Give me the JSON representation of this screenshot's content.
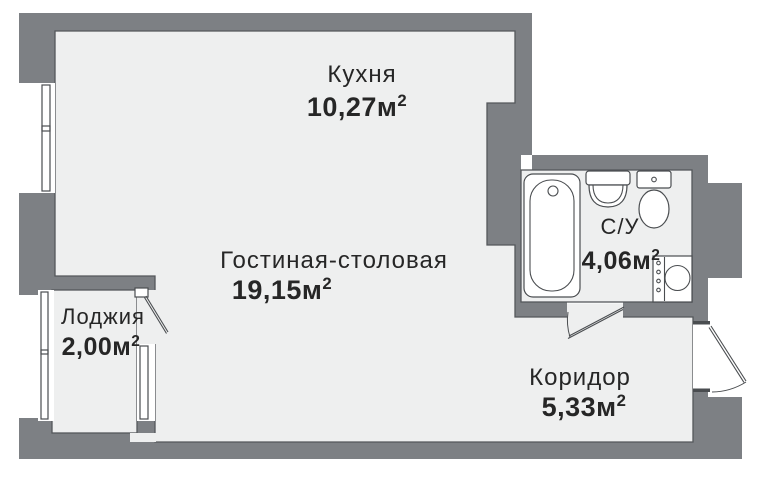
{
  "plan": {
    "title": "Studio apartment floor plan",
    "rooms": [
      {
        "id": "kitchen",
        "name": "Кухня",
        "area": "10,27м",
        "area_sup": "2"
      },
      {
        "id": "living",
        "name": "Гостиная-столовая",
        "area": "19,15м",
        "area_sup": "2"
      },
      {
        "id": "loggia",
        "name": "Лоджия",
        "area": "2,00м",
        "area_sup": "2"
      },
      {
        "id": "bathroom",
        "name": "С/У",
        "area": "4,06м",
        "area_sup": "2"
      },
      {
        "id": "corridor",
        "name": "Коридор",
        "area": "5,33м",
        "area_sup": "2"
      }
    ],
    "fixtures": [
      "bathtub-icon",
      "sink-icon",
      "toilet-icon",
      "washing-machine-icon"
    ],
    "doors": [
      "loggia-door",
      "bathroom-door",
      "entrance-door"
    ],
    "windows": [
      "kitchen-window",
      "loggia-window-upper",
      "loggia-window-lower",
      "loggia-inner-window"
    ],
    "colors": {
      "wall": "#7d8084",
      "floor": "#eeefef",
      "line": "#54575b",
      "fixture": "#4a4d50",
      "text": "#262626",
      "background": "#ffffff",
      "white": "#ffffff"
    }
  }
}
